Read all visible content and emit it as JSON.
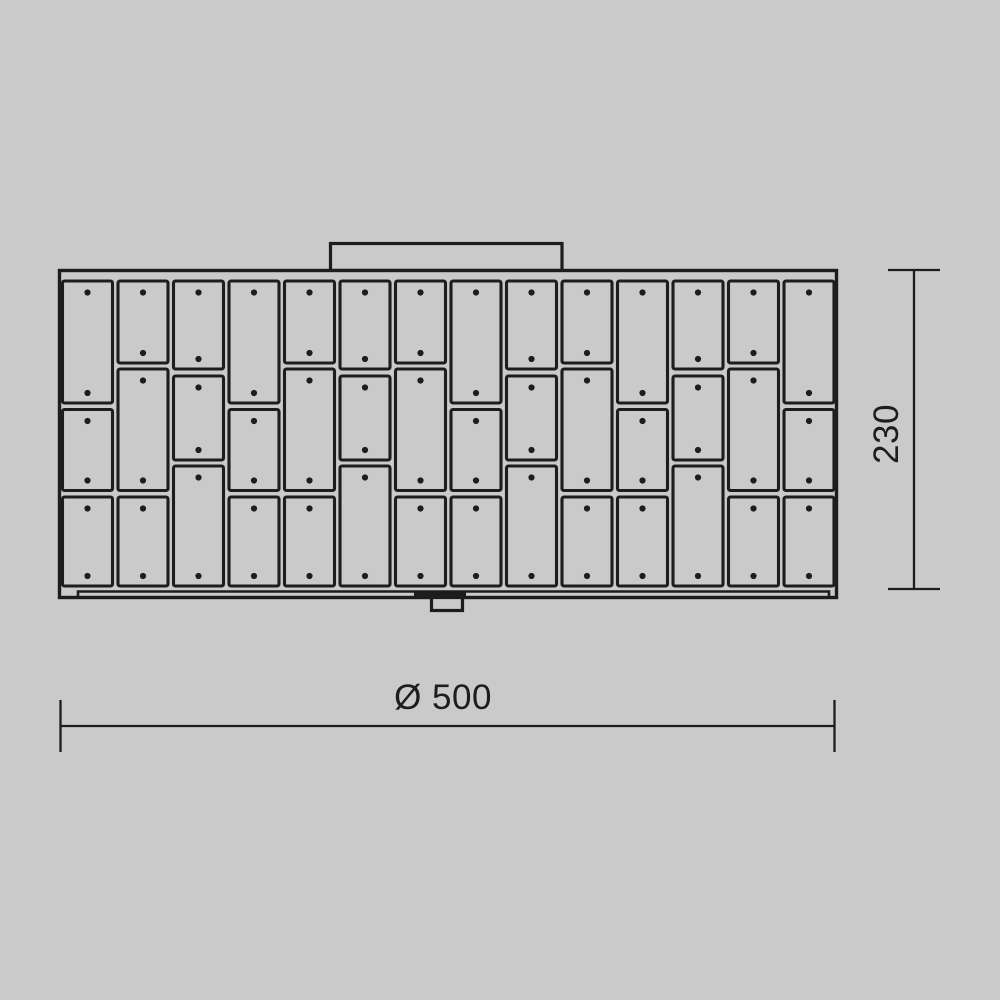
{
  "colors": {
    "background": "#cacaca",
    "line": "#1d1d1d"
  },
  "dimensions": {
    "width": {
      "label": "Ø 500"
    },
    "height": {
      "label": "230"
    }
  },
  "panel_grid": {
    "columns": 14,
    "column_types": [
      "A",
      "B",
      "C",
      "A",
      "B",
      "C",
      "B",
      "A",
      "C",
      "B",
      "A",
      "C",
      "B",
      "A"
    ],
    "types": {
      "A": [
        [
          281,
          403
        ],
        [
          409.5,
          490.5
        ],
        [
          497,
          586
        ]
      ],
      "B": [
        [
          281,
          363
        ],
        [
          369,
          490.5
        ],
        [
          497,
          586
        ]
      ],
      "C": [
        [
          281,
          369
        ],
        [
          376,
          460
        ],
        [
          466,
          586
        ]
      ]
    },
    "origin_x": 62.5,
    "pitch": 55.5,
    "panel_width": 50,
    "corner_radius": 2,
    "dot_inset_top": 11.5,
    "dot_inset_bottom": 10,
    "dot_radius": 3.1,
    "screws_per_panel": 2
  }
}
